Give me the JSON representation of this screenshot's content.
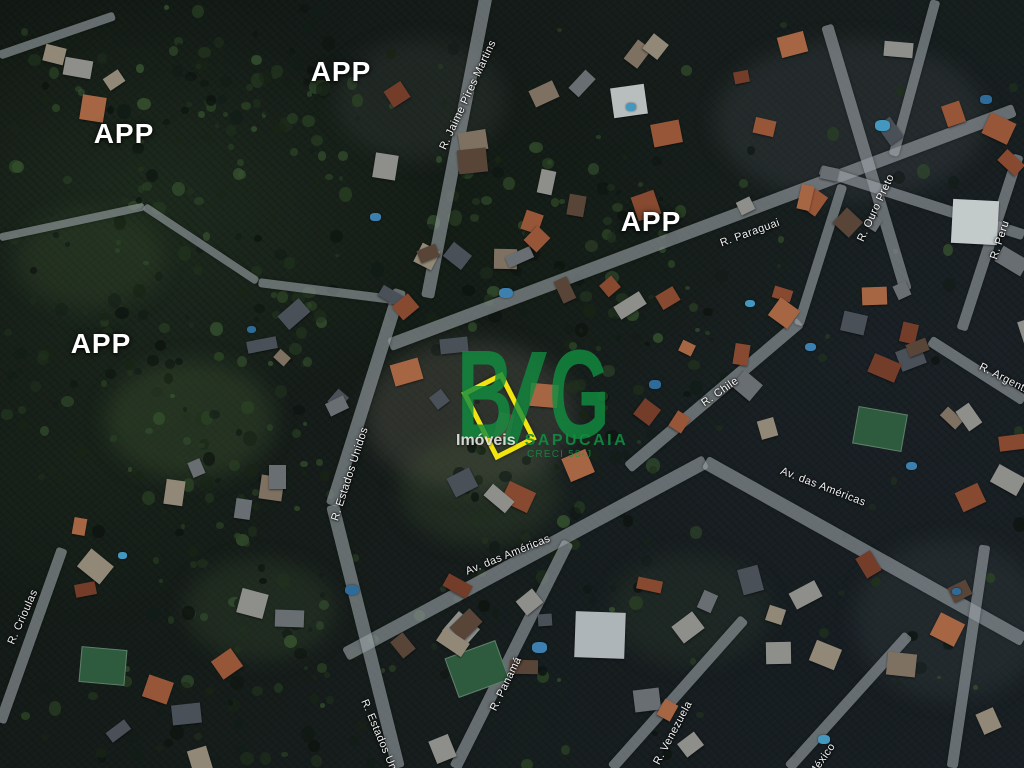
{
  "map": {
    "kind": "satellite-aerial-photo",
    "watermark": {
      "letter_b": "B",
      "letter_g": "G",
      "line1_left": "Imóveis",
      "line1_right": "SAPUCAIA",
      "line2": "CRECI 58-J",
      "brand_color": "#118c40"
    },
    "highlight_lot": {
      "border_color": "#f2e40e",
      "x": 476,
      "y": 378,
      "w": 46,
      "h": 76,
      "rot": -27
    },
    "area_labels": [
      {
        "text": "APP",
        "x": 124,
        "y": 134
      },
      {
        "text": "APP",
        "x": 341,
        "y": 72
      },
      {
        "text": "APP",
        "x": 651,
        "y": 222
      },
      {
        "text": "APP",
        "x": 101,
        "y": 344
      }
    ],
    "street_labels": [
      {
        "text": "R. Jaime Pires Martins",
        "x": 468,
        "y": 95,
        "rot": -65
      },
      {
        "text": "R. Paraguai",
        "x": 750,
        "y": 233,
        "rot": -20
      },
      {
        "text": "R. Ouro Preto",
        "x": 876,
        "y": 208,
        "rot": -65
      },
      {
        "text": "R. Peru",
        "x": 1000,
        "y": 240,
        "rot": -72
      },
      {
        "text": "R. Argentina",
        "x": 1009,
        "y": 381,
        "rot": 27
      },
      {
        "text": "R. Chile",
        "x": 720,
        "y": 392,
        "rot": -35
      },
      {
        "text": "Av. das Américas",
        "x": 823,
        "y": 487,
        "rot": 21
      },
      {
        "text": "Av. das Américas",
        "x": 508,
        "y": 555,
        "rot": -22
      },
      {
        "text": "R. Estados Unidos",
        "x": 350,
        "y": 474,
        "rot": -72
      },
      {
        "text": "R. Crioulas",
        "x": 23,
        "y": 617,
        "rot": -66
      },
      {
        "text": "R. Estados Unidos",
        "x": 383,
        "y": 745,
        "rot": 67
      },
      {
        "text": "R. Panamá",
        "x": 506,
        "y": 684,
        "rot": -64
      },
      {
        "text": "R. Venezuela",
        "x": 673,
        "y": 733,
        "rot": -62
      },
      {
        "text": "R. México",
        "x": 818,
        "y": 766,
        "rot": -55
      }
    ]
  }
}
